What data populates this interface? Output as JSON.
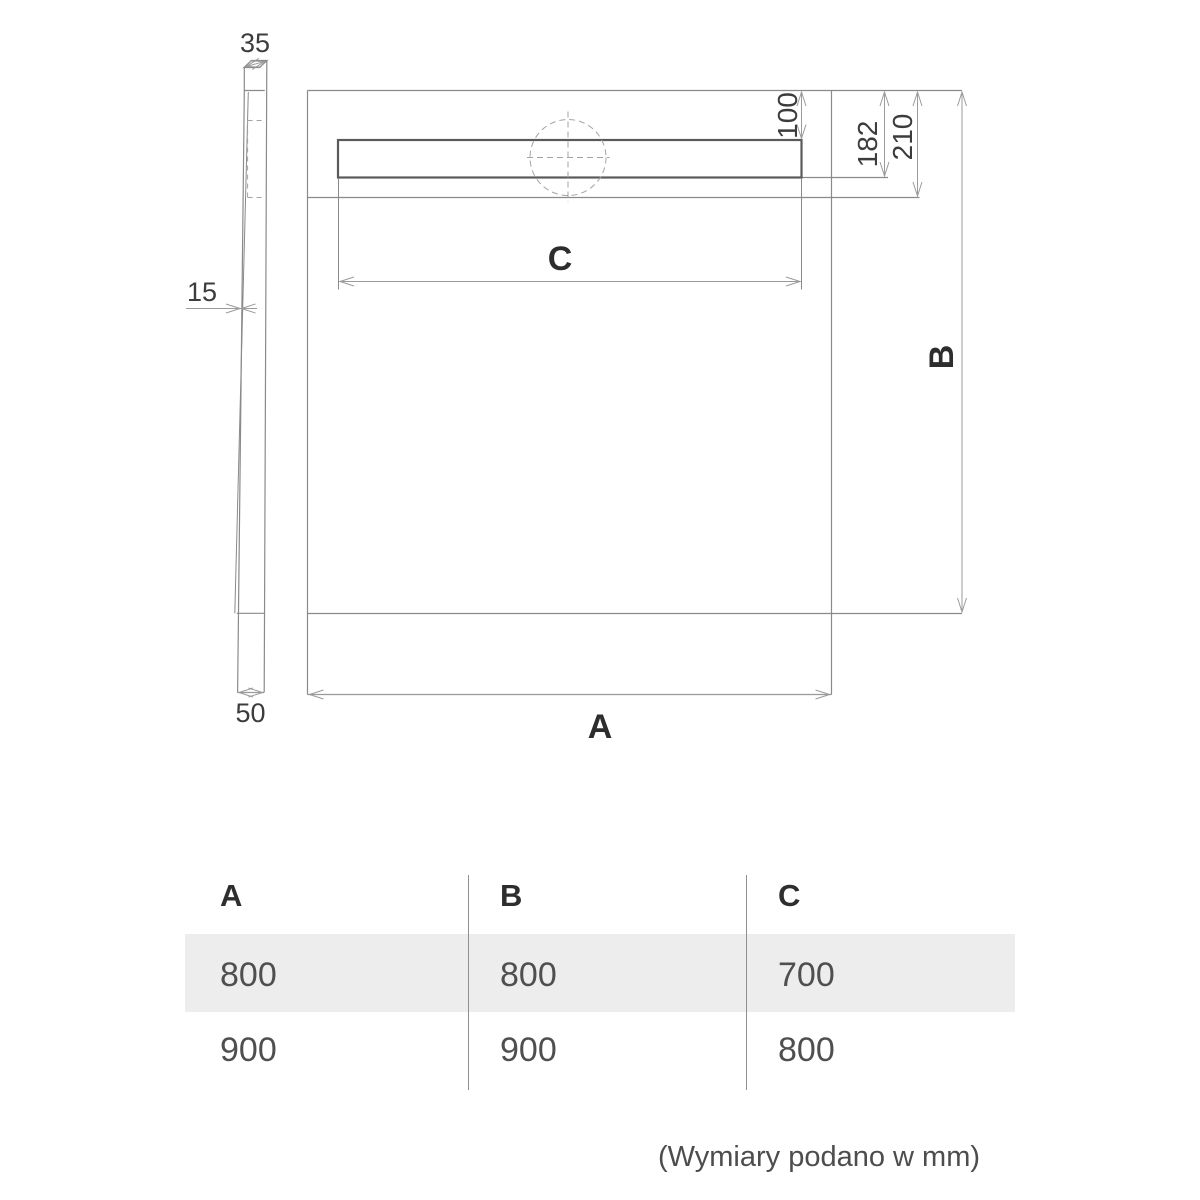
{
  "diagram": {
    "caption": "(Wymiary podano w mm)",
    "side_view": {
      "top_thickness": "35",
      "wall_thickness": "15",
      "base_height": "50"
    },
    "top_view": {
      "width_label": "A",
      "depth_label": "B",
      "drain_length_label": "C",
      "drain_top_offset": "100",
      "drain_bottom_offset": "182",
      "inner_edge_offset": "210"
    }
  },
  "table": {
    "headers": [
      "A",
      "B",
      "C"
    ],
    "rows": [
      [
        "800",
        "800",
        "700"
      ],
      [
        "900",
        "900",
        "800"
      ]
    ]
  },
  "colors": {
    "outline": "#8a8a8a",
    "dimension_line": "#9b9b9b",
    "channel_stroke": "#5a5a5a",
    "text_dark": "#2d2d2d",
    "text_dim": "#3c3c3c",
    "value_gray": "#4f4f4f",
    "row_shade": "#ededed",
    "background": "#ffffff"
  }
}
